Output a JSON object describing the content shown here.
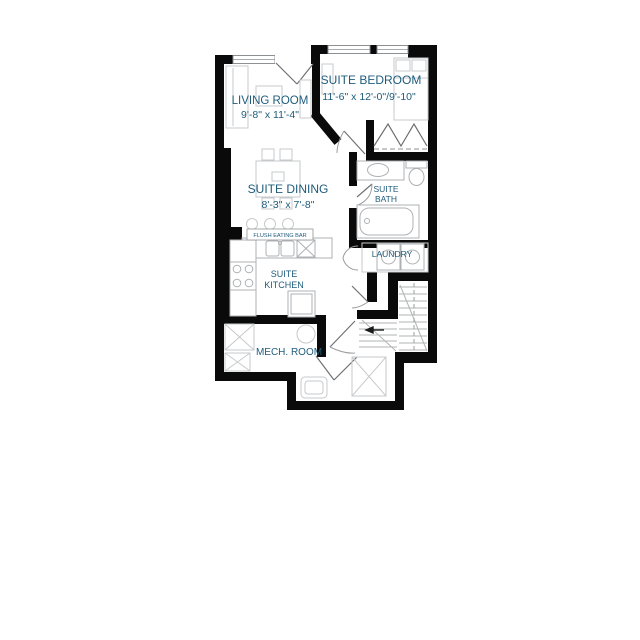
{
  "plan": {
    "rooms": {
      "living_room": {
        "label": "LIVING ROOM",
        "dims": "9'-8\" x 11'-4\""
      },
      "suite_bedroom": {
        "label": "SUITE BEDROOM",
        "dims": "11'-6\" x 12'-0\"/9'-10\""
      },
      "suite_dining": {
        "label": "SUITE DINING",
        "dims": "8'-3\" x 7'-8\""
      },
      "suite_bath": {
        "label_line1": "SUITE",
        "label_line2": "BATH"
      },
      "suite_kitchen": {
        "label_line1": "SUITE",
        "label_line2": "KITCHEN"
      },
      "laundry": {
        "label": "LAUNDRY"
      },
      "mech_room": {
        "label": "MECH. ROOM"
      },
      "flush_eating_bar": {
        "label": "FLUSH EATING BAR"
      }
    },
    "colors": {
      "wall": "#0a0a0a",
      "label_text": "#1e5c7c",
      "furniture_line": "#c7c9cb",
      "fixture_line": "#aeb1b4",
      "background": "#ffffff"
    }
  }
}
